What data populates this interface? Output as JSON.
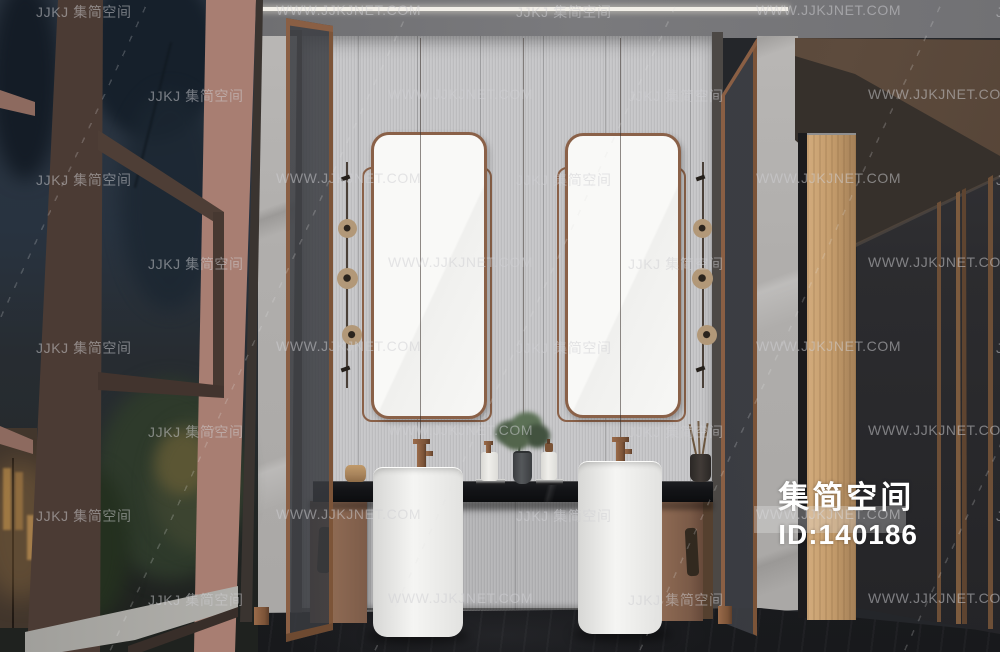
{
  "watermark": {
    "brand_text": "JJKJ 集简空间",
    "url_text": "WWW.JJKJNET.COM",
    "grid": {
      "rows": 8,
      "cols": 5,
      "row_start_y": 2,
      "row_spacing": 84,
      "even_row_x": 36,
      "odd_row_x": 148,
      "col_spacing": 240
    }
  },
  "id_label": {
    "brand": "集简空间",
    "id": "ID:140186"
  },
  "palette": {
    "watermark_gray": "#d0d0d2",
    "id_text_white": "#ffffff",
    "copper_accent": "#8a5f44",
    "fluted_wall_gray": "#c6c6c8",
    "marble_gray": "#b3b1af",
    "counter_black": "#141518",
    "cabinet_brown": "#8a6752",
    "pedestal_white": "#f2f2f0",
    "wood_column_tan": "#c29a6a",
    "window_frame_mauve": "#a1796d",
    "dark_wall": "#2e2d30",
    "floor_charcoal": "#212225",
    "night_sky_blue": "#2c3642",
    "ceiling_gray": "#77777a",
    "light_strip_white": "#f2efe8"
  }
}
